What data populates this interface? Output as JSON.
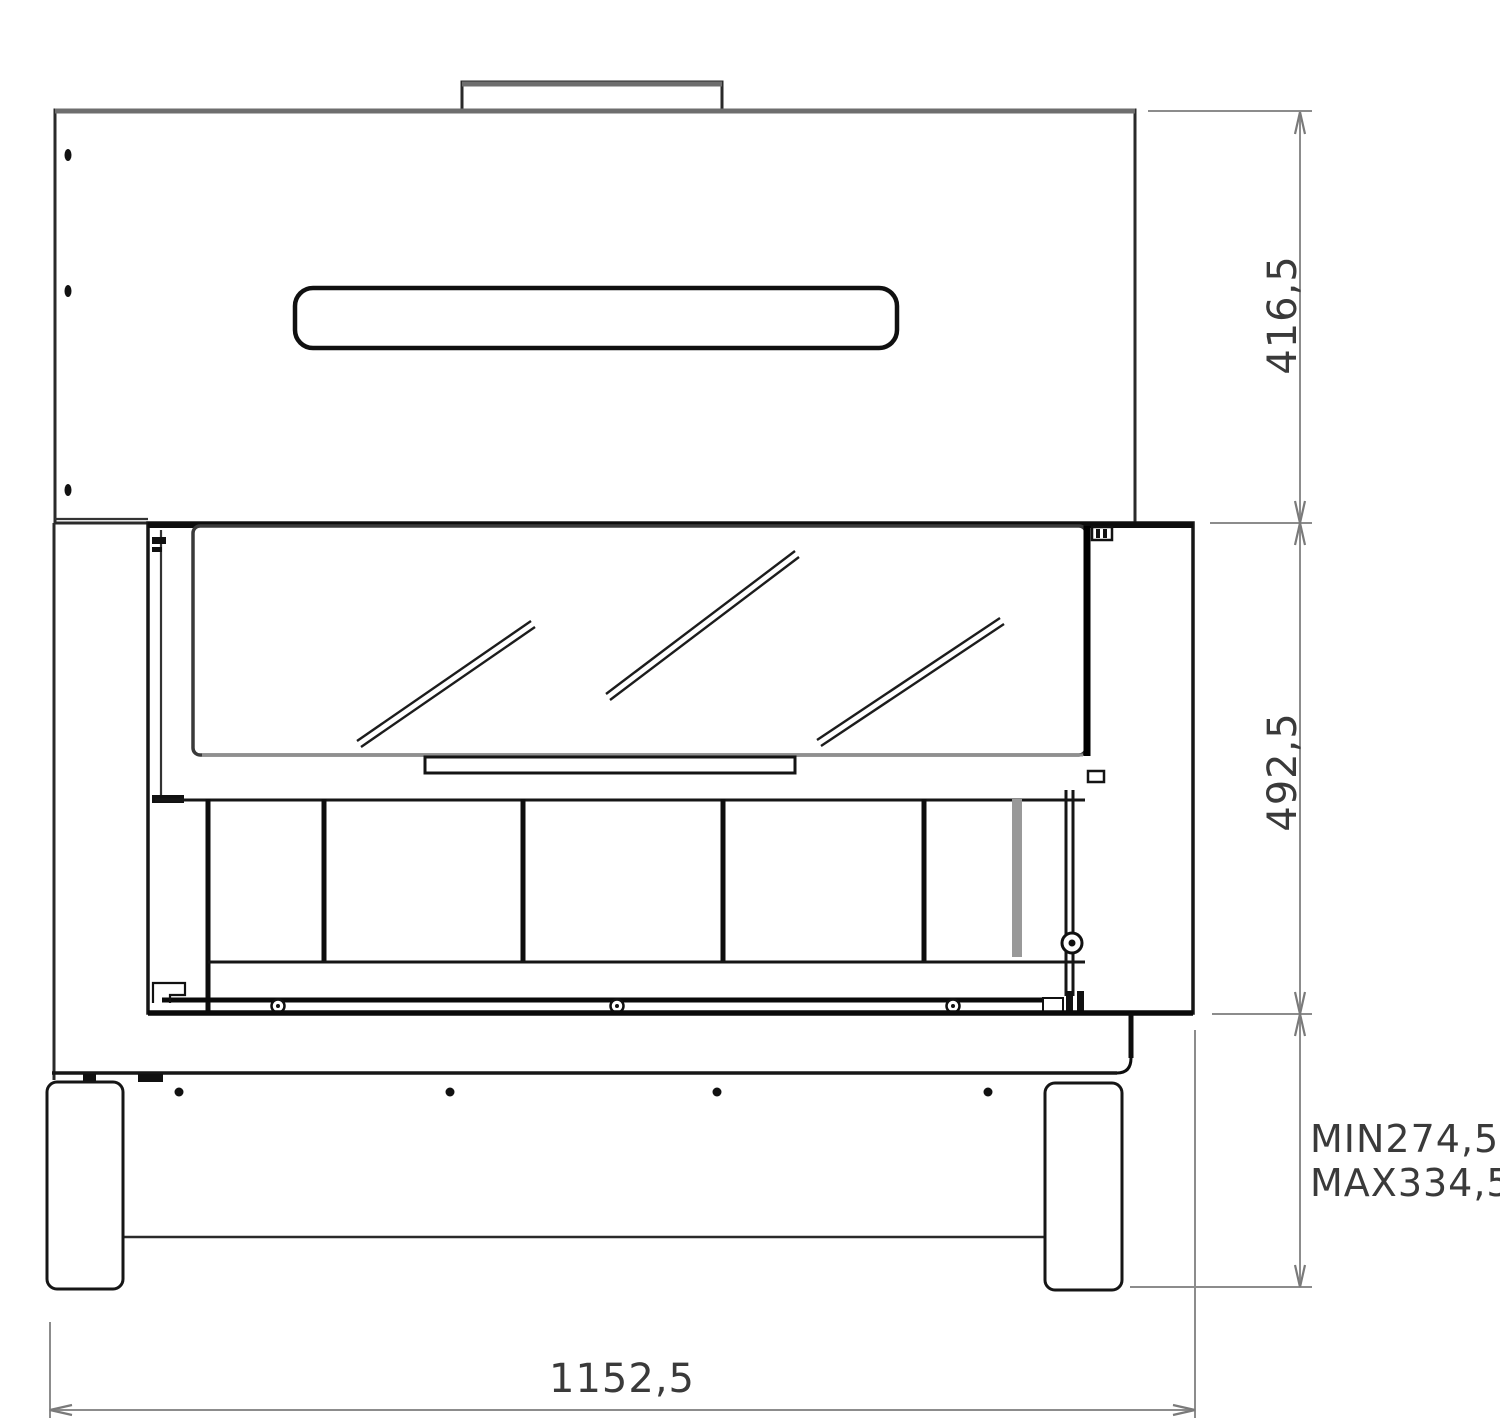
{
  "drawing": {
    "type": "fireplace-front-elevation-technical-drawing",
    "labels": {
      "hood_height": "416,5",
      "firebox_height": "492,5",
      "base_height_min": "MIN274,5",
      "base_height_max": "MAX334,5",
      "overall_width": "1152,5"
    },
    "colors": {
      "background": "#ffffff",
      "outline": "#222222",
      "heavy_outline": "#0d0d0d",
      "shaded_edge": "#6e6e6e",
      "inner_shade": "#999999",
      "dimension_lines": "#8c8c8c",
      "dimension_text": "#3a3a3a"
    }
  }
}
